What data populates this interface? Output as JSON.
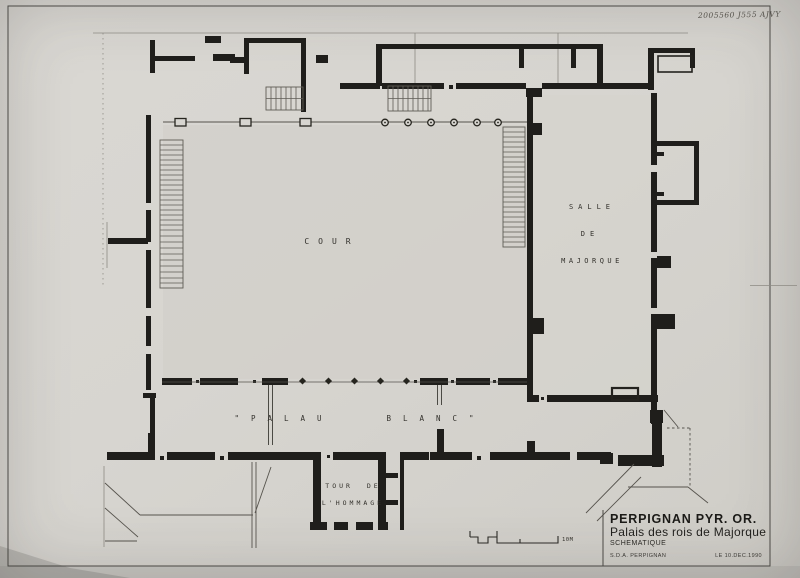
{
  "annotations": {
    "handwritten_ref": "2005560 J555 AJVY"
  },
  "plan": {
    "labels": {
      "cour": "COUR",
      "salle_l1": "SALLE",
      "salle_l2": "DE",
      "salle_l3": "MAJORQUE",
      "palau_left": "\"PALAU",
      "palau_right": "BLANC\"",
      "tour_l1": "TOUR DE",
      "tour_l2": "L'HOMMAGE"
    },
    "scale_label": "10M"
  },
  "title_block": {
    "region": "PERPIGNAN PYR. OR.",
    "title": "Palais des rois de Majorque",
    "subtitle": "SCHEMATIQUE",
    "agency": "S.D.A. PERPIGNAN",
    "date": "LE 10.DEC.1990"
  },
  "colors": {
    "paper": "#d7d5d0",
    "ink": "#1f1e1b",
    "thin_line": "#6b6862"
  }
}
